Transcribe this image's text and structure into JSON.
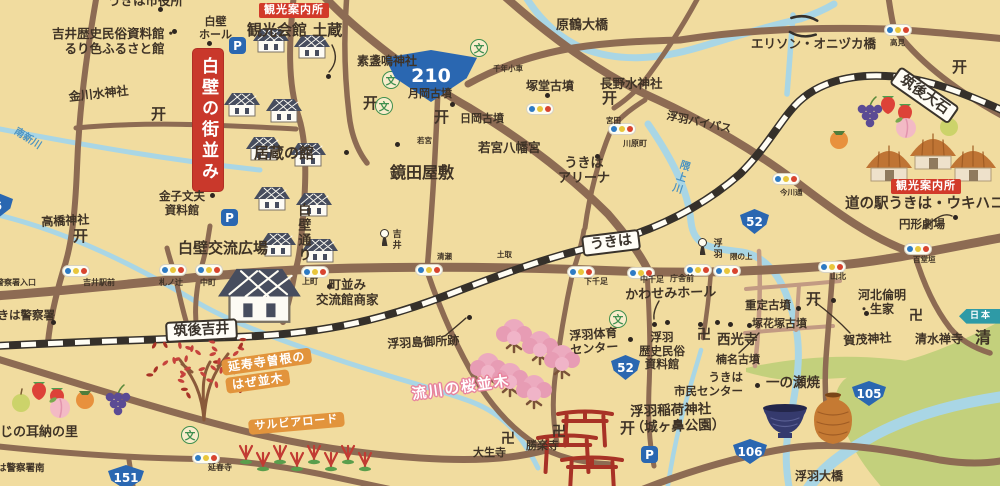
{
  "map_title": "うきは(吉井・浮羽)イラストマップ",
  "colors": {
    "background": "#f1dc9f",
    "road": "#8d6b53",
    "road_light": "#c29a83",
    "river": "#a9d6e5",
    "railway": "#35302a",
    "green_area": "#c3d07c",
    "accent_red": "#c9382b",
    "accent_orange": "#e2943c",
    "route_blue": "#2a67b1",
    "school_green": "#3f8f4f",
    "sakura_pink": "#ecaabf"
  },
  "icons": {
    "torii": "开",
    "temple": "卍",
    "school": "文",
    "parking": "P"
  },
  "labels": [
    {
      "t": "うきは市役所",
      "x": 108,
      "y": -6,
      "f": 12.5,
      "n": "label-ukiha-city-hall"
    },
    {
      "t": "吉井歴史民俗資料館・\nるり色ふるさと館",
      "x": 52,
      "y": 27,
      "f": 12.5,
      "c": "ctr",
      "n": "label-yoshii-history-museum"
    },
    {
      "t": "白壁\nホール",
      "x": 199,
      "y": 16,
      "f": 11,
      "c": "ctr",
      "n": "label-shirakabe-hall"
    },
    {
      "t": "金川水神社",
      "x": 68,
      "y": 90,
      "f": 12,
      "r": -6,
      "n": "label-kanagawa-water-shrine"
    },
    {
      "t": "観光案内所",
      "x": 259,
      "y": 3,
      "f": 11,
      "c": "badge",
      "n": "badge-tourist-info-yoshii"
    },
    {
      "t": "観光会館 土蔵",
      "x": 247,
      "y": 22,
      "f": 15,
      "n": "label-kanko-kaikan-dozo"
    },
    {
      "t": "素盞嗚神社",
      "x": 357,
      "y": 54,
      "f": 12,
      "n": "label-susanoo-shrine"
    },
    {
      "t": "月岡古墳",
      "x": 408,
      "y": 88,
      "f": 11,
      "n": "label-tsukioka-kofun"
    },
    {
      "t": "日岡古墳",
      "x": 460,
      "y": 113,
      "f": 11,
      "n": "label-hioka-kofun"
    },
    {
      "t": "千年小車",
      "x": 493,
      "y": 65,
      "f": 7.5,
      "n": "label-chitose"
    },
    {
      "t": "塚堂古墳",
      "x": 526,
      "y": 79,
      "f": 12,
      "n": "label-tsukando-kofun"
    },
    {
      "t": "長野水神社",
      "x": 600,
      "y": 77,
      "f": 12.5,
      "n": "label-nagano-water-shrine"
    },
    {
      "t": "原鶴大橋",
      "x": 556,
      "y": 18,
      "f": 13,
      "n": "label-harazuru-bridge"
    },
    {
      "t": "エリソン・オニヅカ橋",
      "x": 751,
      "y": 37,
      "f": 12.5,
      "n": "label-ellison-onizuka-bridge"
    },
    {
      "t": "高見",
      "x": 890,
      "y": 39,
      "f": 7.5,
      "n": "label-takami-signal"
    },
    {
      "t": "筑後大石",
      "x": 901,
      "y": 66,
      "f": 14,
      "r": 35,
      "c": "station",
      "n": "station-chikugo-oishi"
    },
    {
      "t": "浮羽バイパス",
      "x": 668,
      "y": 110,
      "f": 11,
      "r": 12,
      "n": "label-ukiha-bypass"
    },
    {
      "t": "南新川",
      "x": 18,
      "y": 126,
      "f": 10,
      "r": 33,
      "c": "blue",
      "n": "label-minami-shinkawa-river"
    },
    {
      "t": "白壁の街並み",
      "x": 193,
      "y": 49,
      "f": 17,
      "c": "banner",
      "n": "banner-shirakabe-townscape"
    },
    {
      "t": "居蔵の館",
      "x": 254,
      "y": 145,
      "f": 15,
      "n": "label-igura-no-yakata"
    },
    {
      "t": "鏡田屋敷",
      "x": 390,
      "y": 164,
      "f": 16,
      "n": "label-kagamida-yashiki"
    },
    {
      "t": "若宮",
      "x": 417,
      "y": 137,
      "f": 7.5,
      "n": "label-wakamiya-signal"
    },
    {
      "t": "若宮八幡宮",
      "x": 478,
      "y": 141,
      "f": 12.5,
      "n": "label-wakamiya-hachimangu"
    },
    {
      "t": "宮田",
      "x": 606,
      "y": 117,
      "f": 7.5,
      "n": "label-miyata-signal"
    },
    {
      "t": "川原町",
      "x": 623,
      "y": 139,
      "f": 8,
      "n": "label-kawaramachi-signal"
    },
    {
      "t": "うきは\nアリーナ",
      "x": 558,
      "y": 156,
      "f": 13,
      "c": "ctr",
      "n": "label-ukiha-arena"
    },
    {
      "t": "隈上川",
      "x": 679,
      "y": 158,
      "f": 10,
      "r": 18,
      "c": "blue vert",
      "n": "label-kumanoue-river"
    },
    {
      "t": "今川通",
      "x": 780,
      "y": 189,
      "f": 7.5,
      "n": "label-imagawa-signal"
    },
    {
      "t": "観光案内所",
      "x": 891,
      "y": 179,
      "f": 11,
      "c": "badge",
      "n": "badge-tourist-info-ukiha"
    },
    {
      "t": "道の駅うきは・ウキハコ",
      "x": 845,
      "y": 196,
      "f": 14.5,
      "n": "label-michinoeki-ukiha-ukihako"
    },
    {
      "t": "円形劇場",
      "x": 899,
      "y": 218,
      "f": 11.5,
      "n": "label-enkei-gekijo"
    },
    {
      "t": "金子文夫\n資料館",
      "x": 159,
      "y": 190,
      "f": 11.5,
      "c": "ctr",
      "n": "label-kaneko-fumio-museum"
    },
    {
      "t": "白壁通り",
      "x": 295,
      "y": 203,
      "f": 13,
      "c": "vert",
      "n": "label-shirakabe-street"
    },
    {
      "t": "高橋神社",
      "x": 41,
      "y": 215,
      "f": 12,
      "r": -3,
      "n": "label-takahashi-shrine"
    },
    {
      "t": "白壁交流広場",
      "x": 178,
      "y": 240,
      "f": 15,
      "n": "label-shirakabe-plaza"
    },
    {
      "t": "吉井",
      "x": 390,
      "y": 229,
      "f": 9,
      "c": "vert",
      "n": "label-yoshii-signpost"
    },
    {
      "t": "浮羽",
      "x": 711,
      "y": 238,
      "f": 9,
      "c": "vert",
      "n": "label-ukiha-signpost"
    },
    {
      "t": "うきは",
      "x": 581,
      "y": 236,
      "f": 14,
      "r": -7,
      "c": "station",
      "n": "station-ukiha"
    },
    {
      "t": "筑後吉井",
      "x": 165,
      "y": 322,
      "f": 14,
      "r": -3,
      "c": "station",
      "n": "station-chikugo-yoshii"
    },
    {
      "t": "警察署入口",
      "x": -4,
      "y": 278,
      "f": 8,
      "n": "label-police-entrance-signal"
    },
    {
      "t": "吉井駅前",
      "x": 83,
      "y": 278,
      "f": 8,
      "n": "label-yoshii-ekimae-signal"
    },
    {
      "t": "札ノ辻",
      "x": 159,
      "y": 278,
      "f": 8,
      "n": "label-fudanotsuji-signal"
    },
    {
      "t": "中町",
      "x": 200,
      "y": 278,
      "f": 8,
      "n": "label-nakamachi-signal"
    },
    {
      "t": "上町",
      "x": 302,
      "y": 277,
      "f": 8,
      "n": "label-kammachi-signal"
    },
    {
      "t": "清瀬",
      "x": 437,
      "y": 253,
      "f": 7.5,
      "n": "label-kiyose-signal"
    },
    {
      "t": "土取",
      "x": 497,
      "y": 251,
      "f": 7.5,
      "n": "label-tsuchitori-signal"
    },
    {
      "t": "下千足",
      "x": 584,
      "y": 277,
      "f": 8,
      "n": "label-shimosendari-signal"
    },
    {
      "t": "中千足",
      "x": 640,
      "y": 275,
      "f": 8,
      "n": "label-nakasendari-signal"
    },
    {
      "t": "庁舎前",
      "x": 670,
      "y": 274,
      "f": 8,
      "n": "label-chosha-mae-signal"
    },
    {
      "t": "隈の上",
      "x": 730,
      "y": 253,
      "f": 7.5,
      "n": "label-kumanoue-signal"
    },
    {
      "t": "山北",
      "x": 830,
      "y": 272,
      "f": 8,
      "n": "label-yamakita-signal"
    },
    {
      "t": "百堂垣",
      "x": 913,
      "y": 256,
      "f": 7.5,
      "n": "label-hyakudogaki-signal"
    },
    {
      "t": "うきは警察署",
      "x": -14,
      "y": 309,
      "f": 11.5,
      "n": "label-ukiha-police-station"
    },
    {
      "t": "町並み\n交流館商家",
      "x": 316,
      "y": 278,
      "f": 12.5,
      "c": "ctr",
      "n": "label-machinami-koryukan-shoka"
    },
    {
      "t": "浮羽島御所跡",
      "x": 387,
      "y": 337,
      "f": 12,
      "r": -3,
      "n": "label-ukihajima-gosho-ruins"
    },
    {
      "t": "かわせみホール",
      "x": 625,
      "y": 288,
      "f": 13,
      "r": -2,
      "n": "label-kawasemi-hall"
    },
    {
      "t": "浮羽体育\nセンター",
      "x": 569,
      "y": 329,
      "f": 12,
      "r": -4,
      "c": "ctr",
      "n": "label-ukiha-gym-center"
    },
    {
      "t": "浮羽\n歴史民俗\n資料館",
      "x": 639,
      "y": 331,
      "f": 11.5,
      "c": "ctr",
      "n": "label-ukiha-history-museum"
    },
    {
      "t": "西光寺",
      "x": 717,
      "y": 333,
      "f": 13.5,
      "n": "label-saikoji-temple"
    },
    {
      "t": "楠名古墳",
      "x": 716,
      "y": 354,
      "f": 11,
      "n": "label-kusuna-kofun"
    },
    {
      "t": "うきは\n市民センター",
      "x": 674,
      "y": 371,
      "f": 11.5,
      "c": "rt",
      "n": "label-ukiha-citizen-center"
    },
    {
      "t": "重定古墳",
      "x": 745,
      "y": 299,
      "f": 11.5,
      "n": "label-shigesada-kofun"
    },
    {
      "t": "塚花塚古墳",
      "x": 752,
      "y": 318,
      "f": 11,
      "n": "label-tsukahanazuka-kofun"
    },
    {
      "t": "河北倫明\n・生家",
      "x": 858,
      "y": 288,
      "f": 12,
      "n": "label-kawakita-michiaki-birthplace"
    },
    {
      "t": "賀茂神社",
      "x": 843,
      "y": 334,
      "f": 12,
      "r": -4,
      "n": "label-kamo-shrine"
    },
    {
      "t": "清水禅寺",
      "x": 915,
      "y": 332,
      "f": 12,
      "n": "label-shimizu-zenji-temple"
    },
    {
      "t": "清",
      "x": 975,
      "y": 329,
      "f": 16,
      "n": "label-shimizu-partial"
    },
    {
      "t": "日本",
      "x": 959,
      "y": 309,
      "f": 9,
      "c": "ribbon",
      "n": "ribbon-nihon"
    },
    {
      "t": "一の瀬焼",
      "x": 766,
      "y": 376,
      "f": 13.5,
      "n": "label-ichinose-pottery"
    },
    {
      "t": "浮羽大橋",
      "x": 795,
      "y": 469,
      "f": 12,
      "n": "label-ukiha-ohashi-bridge"
    },
    {
      "t": "浮羽稲荷神社\n（城ヶ鼻公園）",
      "x": 630,
      "y": 405,
      "f": 13.5,
      "r": -2,
      "n": "label-ukiha-inari-shrine"
    },
    {
      "t": "大生寺",
      "x": 473,
      "y": 447,
      "f": 11,
      "n": "label-daishoji-temple"
    },
    {
      "t": "勝楽寺",
      "x": 526,
      "y": 440,
      "f": 11,
      "n": "label-shorakuji-temple"
    },
    {
      "t": "延寿寺曽根の",
      "x": 221,
      "y": 360,
      "f": 12,
      "r": -8,
      "c": "obadge",
      "n": "badge-enjuji-sone-1"
    },
    {
      "t": "はぜ並木",
      "x": 225,
      "y": 378,
      "f": 12,
      "r": -8,
      "c": "obadge",
      "n": "badge-haze-namiki"
    },
    {
      "t": "サルビアロード",
      "x": 248,
      "y": 420,
      "f": 11,
      "r": -5,
      "c": "obadge",
      "n": "badge-salvia-road"
    },
    {
      "t": "流川の桜並木",
      "x": 411,
      "y": 387,
      "f": 14.5,
      "r": -8,
      "c": "sakuraT",
      "n": "label-nagarekawa-sakura"
    },
    {
      "t": "にじの耳納の里",
      "x": -13,
      "y": 425,
      "f": 13,
      "n": "label-niji-minou-no-sato"
    },
    {
      "t": "うきは警察署南",
      "x": -22,
      "y": 463,
      "f": 9.5,
      "n": "label-police-south-signal"
    },
    {
      "t": "延春寺",
      "x": 208,
      "y": 463,
      "f": 8,
      "n": "label-enshunji-signal"
    }
  ],
  "route_shields": [
    {
      "num": "210",
      "x": 384,
      "y": 50,
      "w": 94,
      "h": 52,
      "shape": "tri",
      "f": 19
    },
    {
      "num": "52",
      "x": 740,
      "y": 209,
      "w": 29,
      "h": 25,
      "f": 12
    },
    {
      "num": "52",
      "x": 611,
      "y": 355,
      "w": 29,
      "h": 25,
      "f": 12
    },
    {
      "num": "105",
      "x": 852,
      "y": 381,
      "w": 34,
      "h": 25,
      "f": 12
    },
    {
      "num": "106",
      "x": 733,
      "y": 439,
      "w": 34,
      "h": 25,
      "f": 12
    },
    {
      "num": "151",
      "x": 108,
      "y": 465,
      "w": 36,
      "h": 25,
      "f": 12
    },
    {
      "num": "6",
      "x": -17,
      "y": 193,
      "w": 30,
      "h": 25,
      "f": 11.5
    }
  ],
  "traffic_lights": [
    [
      62,
      265
    ],
    [
      159,
      264
    ],
    [
      195,
      264
    ],
    [
      301,
      266
    ],
    [
      415,
      264
    ],
    [
      567,
      266
    ],
    [
      627,
      267
    ],
    [
      684,
      264
    ],
    [
      713,
      265
    ],
    [
      818,
      261
    ],
    [
      904,
      243
    ],
    [
      884,
      24
    ],
    [
      608,
      123
    ],
    [
      526,
      103
    ],
    [
      772,
      173
    ],
    [
      192,
      452
    ]
  ],
  "poi_icons": {
    "torii": [
      [
        151,
        107
      ],
      [
        363,
        96
      ],
      [
        434,
        110
      ],
      [
        602,
        91
      ],
      [
        73,
        229
      ],
      [
        952,
        60
      ],
      [
        806,
        292
      ],
      [
        620,
        421
      ]
    ],
    "temple": [
      [
        697,
        328
      ],
      [
        909,
        309
      ],
      [
        501,
        432
      ],
      [
        552,
        425
      ]
    ],
    "school": [
      [
        470,
        39
      ],
      [
        382,
        71
      ],
      [
        375,
        97
      ],
      [
        609,
        310
      ],
      [
        181,
        426
      ]
    ],
    "parking": [
      [
        229,
        37
      ],
      [
        221,
        209
      ],
      [
        641,
        446
      ]
    ],
    "signposts": [
      [
        379,
        229
      ],
      [
        697,
        238
      ]
    ],
    "dots": [
      [
        158,
        7
      ],
      [
        172,
        29
      ],
      [
        207,
        41
      ],
      [
        326,
        74
      ],
      [
        344,
        150
      ],
      [
        395,
        142
      ],
      [
        450,
        102
      ],
      [
        545,
        93
      ],
      [
        210,
        193
      ],
      [
        595,
        154
      ],
      [
        467,
        315
      ],
      [
        327,
        284
      ],
      [
        628,
        337
      ],
      [
        652,
        322
      ],
      [
        665,
        320
      ],
      [
        698,
        322
      ],
      [
        715,
        320
      ],
      [
        728,
        322
      ],
      [
        864,
        311
      ],
      [
        747,
        323
      ],
      [
        796,
        306
      ],
      [
        831,
        298
      ],
      [
        755,
        383
      ],
      [
        953,
        215
      ],
      [
        51,
        320
      ]
    ]
  },
  "illustrations": {
    "kura_houses": [
      [
        253,
        26
      ],
      [
        294,
        32
      ],
      [
        224,
        90
      ],
      [
        266,
        96
      ],
      [
        246,
        134
      ],
      [
        290,
        140
      ],
      [
        254,
        184
      ],
      [
        296,
        190
      ],
      [
        260,
        230
      ],
      [
        302,
        236
      ]
    ],
    "big_house": [
      218,
      262
    ],
    "thatched_huts": [
      [
        866,
        144
      ],
      [
        910,
        132
      ],
      [
        950,
        144
      ]
    ],
    "fruits": [
      {
        "t": "grape",
        "x": 858,
        "y": 106
      },
      {
        "t": "strawberry",
        "x": 880,
        "y": 96
      },
      {
        "t": "strawberry",
        "x": 897,
        "y": 104
      },
      {
        "t": "persimmon",
        "x": 830,
        "y": 130
      },
      {
        "t": "peach",
        "x": 896,
        "y": 118
      },
      {
        "t": "pear",
        "x": 940,
        "y": 118
      },
      {
        "t": "pear",
        "x": 12,
        "y": 394
      },
      {
        "t": "strawberry",
        "x": 31,
        "y": 382
      },
      {
        "t": "strawberry",
        "x": 49,
        "y": 388
      },
      {
        "t": "peach",
        "x": 50,
        "y": 398
      },
      {
        "t": "persimmon",
        "x": 76,
        "y": 390
      },
      {
        "t": "grape",
        "x": 106,
        "y": 394
      }
    ],
    "pottery": [
      {
        "t": "bowl",
        "x": 763,
        "y": 402
      },
      {
        "t": "vase",
        "x": 812,
        "y": 394
      }
    ],
    "sakura_trees": [
      [
        504,
        322
      ],
      [
        530,
        334
      ],
      [
        552,
        348
      ],
      [
        478,
        356
      ],
      [
        500,
        366
      ],
      [
        524,
        378
      ]
    ],
    "hazel_tree": [
      152,
      316
    ],
    "salvia_row": [
      246,
      436
    ],
    "red_torii_gates": [
      [
        558,
        412,
        54
      ],
      [
        538,
        436,
        58
      ],
      [
        562,
        458,
        60
      ]
    ]
  }
}
